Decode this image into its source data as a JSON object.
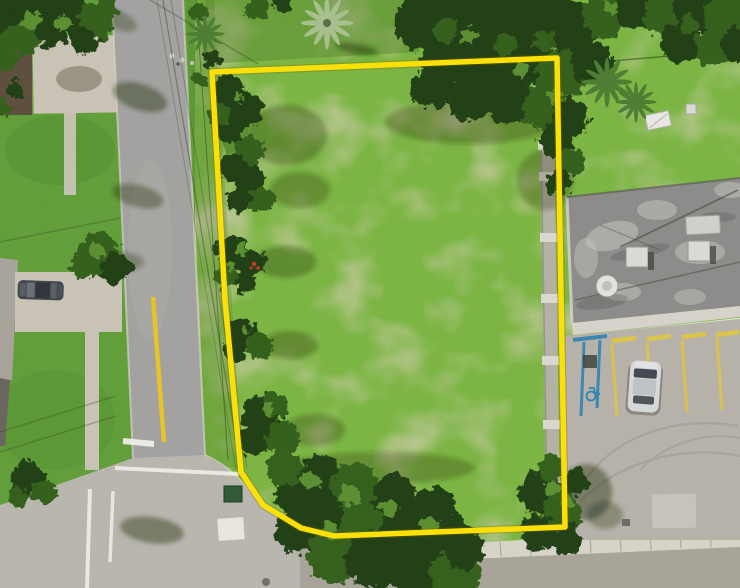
{
  "scene": {
    "type": "aerial-drone-photo",
    "description": "Aerial drone photo of a vacant grassy lot outlined with a yellow property-boundary line; residential street and driveways on the left, dense tree canopy along the top and bottom edges, and a flat-roofed commercial building with a striped parking lot on the right; street intersection at bottom left.",
    "visible_objects": [
      "vacant-lot",
      "property-boundary-line",
      "residential-street",
      "street-intersection",
      "cross-street",
      "driveways",
      "house-roof",
      "parked-gray-car",
      "tree-canopies",
      "palm-trees",
      "commercial-building-roof",
      "rooftop-ac-units",
      "rooftop-vent",
      "parking-lot",
      "parking-space-lines",
      "handicap-space",
      "parked-silver-car",
      "concrete-boundary-wall",
      "sidewalk",
      "green-bin",
      "curb-ramp-pad",
      "utility-lines"
    ]
  },
  "boundary": {
    "points": "212,72 557,58 565,527 334,536 301,528 263,505 241,472 225,300",
    "color": "#fbe106",
    "stroke_width": 5.5
  },
  "colors": {
    "lawn": "#619f38",
    "lawnDark": "#4e8a2e",
    "lot": "#7cb742",
    "lotLight": "#94cc55",
    "olive": "#55832f",
    "treeDark": "#233f19",
    "treeMid": "#35611f",
    "treeLight": "#5c8f33",
    "palmSilver": "#a9c08e",
    "palmGreen": "#4e7d33",
    "road": "#a3a2a0",
    "roadLight": "#b9b6ae",
    "roadBottom": "#a9a499",
    "concrete": "#c9c4b6",
    "sidewalk": "#d7d4c8",
    "roof": "#8d8c8a",
    "roofLight": "#c6c5c1",
    "roofDark": "#565450",
    "wall": "#b6b2aa",
    "post": "#dbd8d0",
    "parking": "#b7b3aa",
    "parkingLight": "#c9c5bc",
    "paintYellow": "#e0c63e",
    "paintWhite": "#f0efe9",
    "roadEdgeYellow": "#e8c428",
    "accessBlue": "#2f84b5",
    "carGray": "#40444b",
    "carSilver": "#d7d8d9",
    "binGreen": "#2f5c35",
    "dirt": "#5d4f3c",
    "flowerRed": "#c43b2a",
    "shadow": "#16290f"
  }
}
